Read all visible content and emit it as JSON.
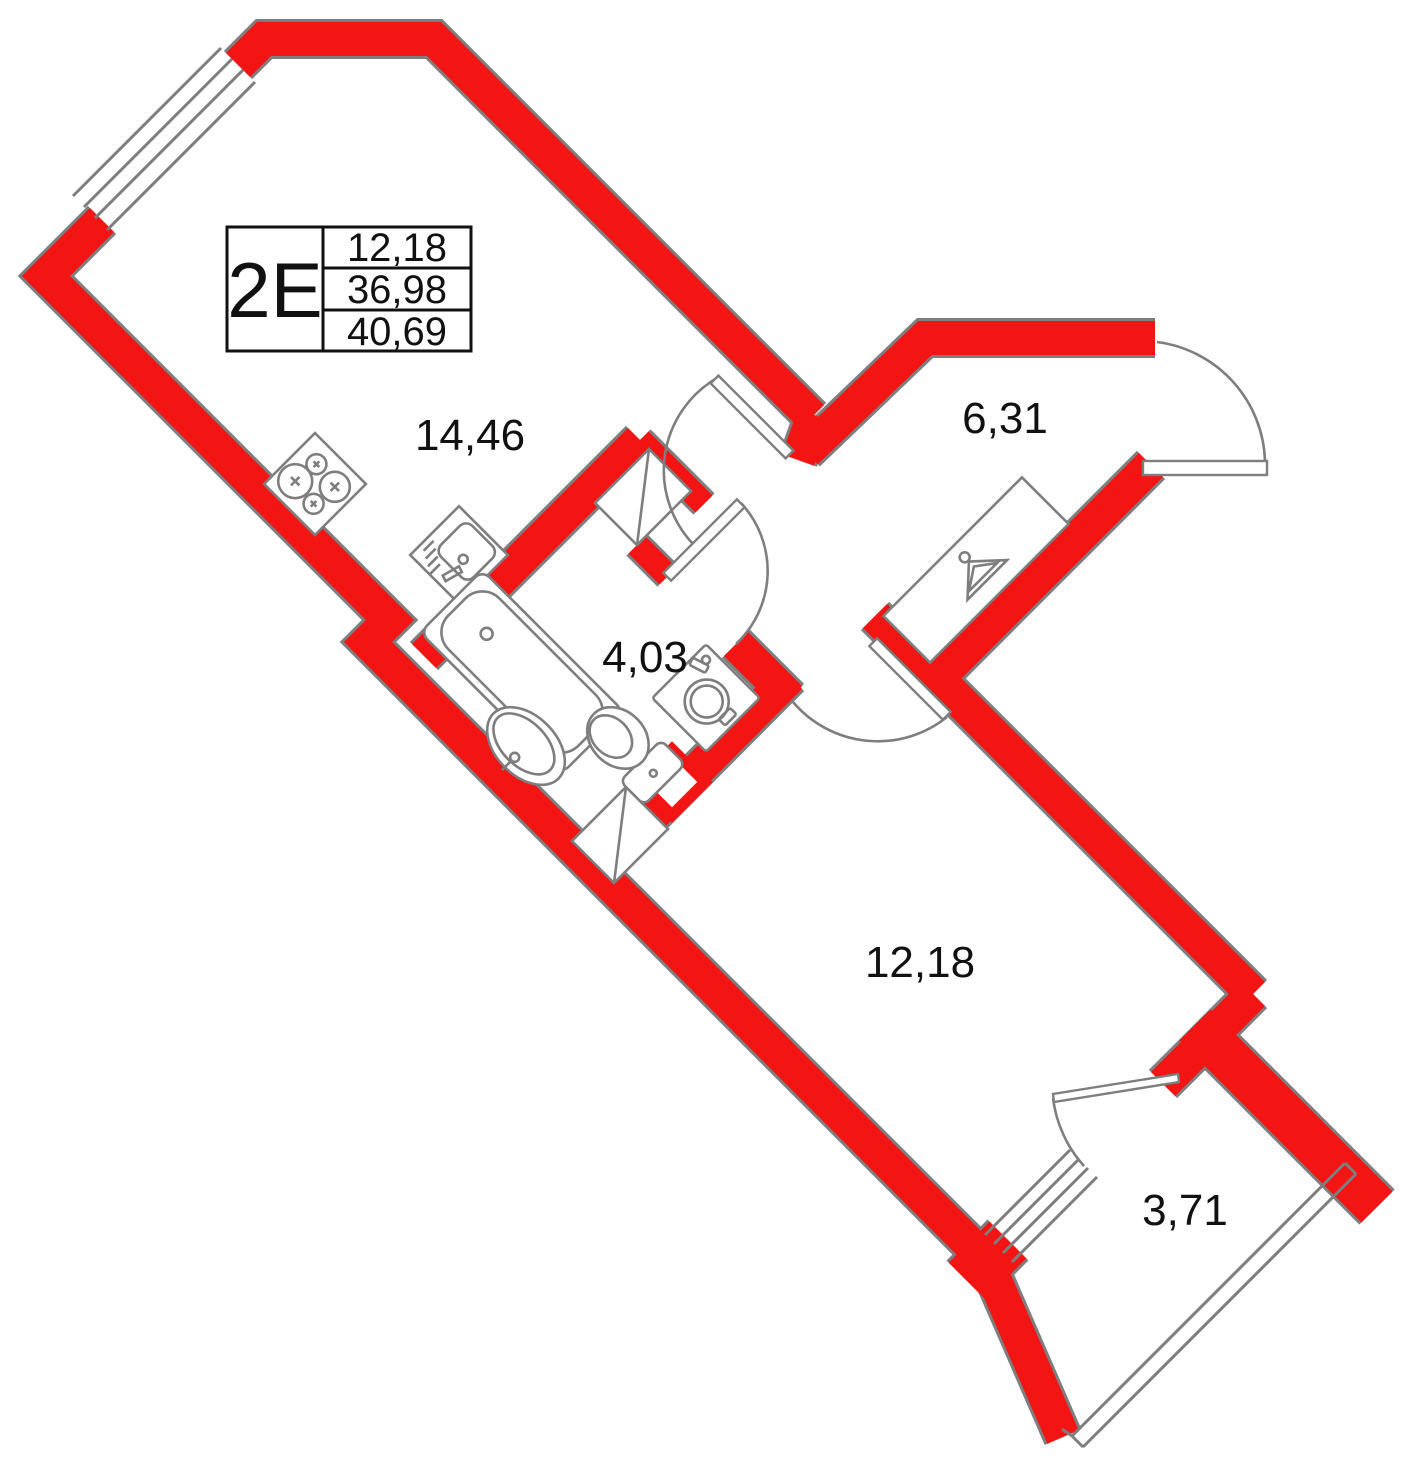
{
  "plan": {
    "title_block": {
      "code": "2E",
      "rows": [
        "12,18",
        "36,98",
        "40,69"
      ]
    },
    "rooms": [
      {
        "name": "kitchen-living-room",
        "area": "14,46"
      },
      {
        "name": "hallway",
        "area": "6,31"
      },
      {
        "name": "bathroom",
        "area": "4,03"
      },
      {
        "name": "room",
        "area": "12,18"
      },
      {
        "name": "balcony",
        "area": "3,71"
      }
    ],
    "fixtures": [
      "stove-icon",
      "kitchen-sink-icon",
      "bathtub-icon",
      "washbasin-icon",
      "toilet-icon",
      "washing-machine-icon",
      "wardrobe-hanger-icon",
      "ventilation-shaft-icon",
      "duct-icon"
    ],
    "colors": {
      "wall_red": "#f31414",
      "line_gray": "#7e7e7e",
      "text": "#111111"
    }
  }
}
